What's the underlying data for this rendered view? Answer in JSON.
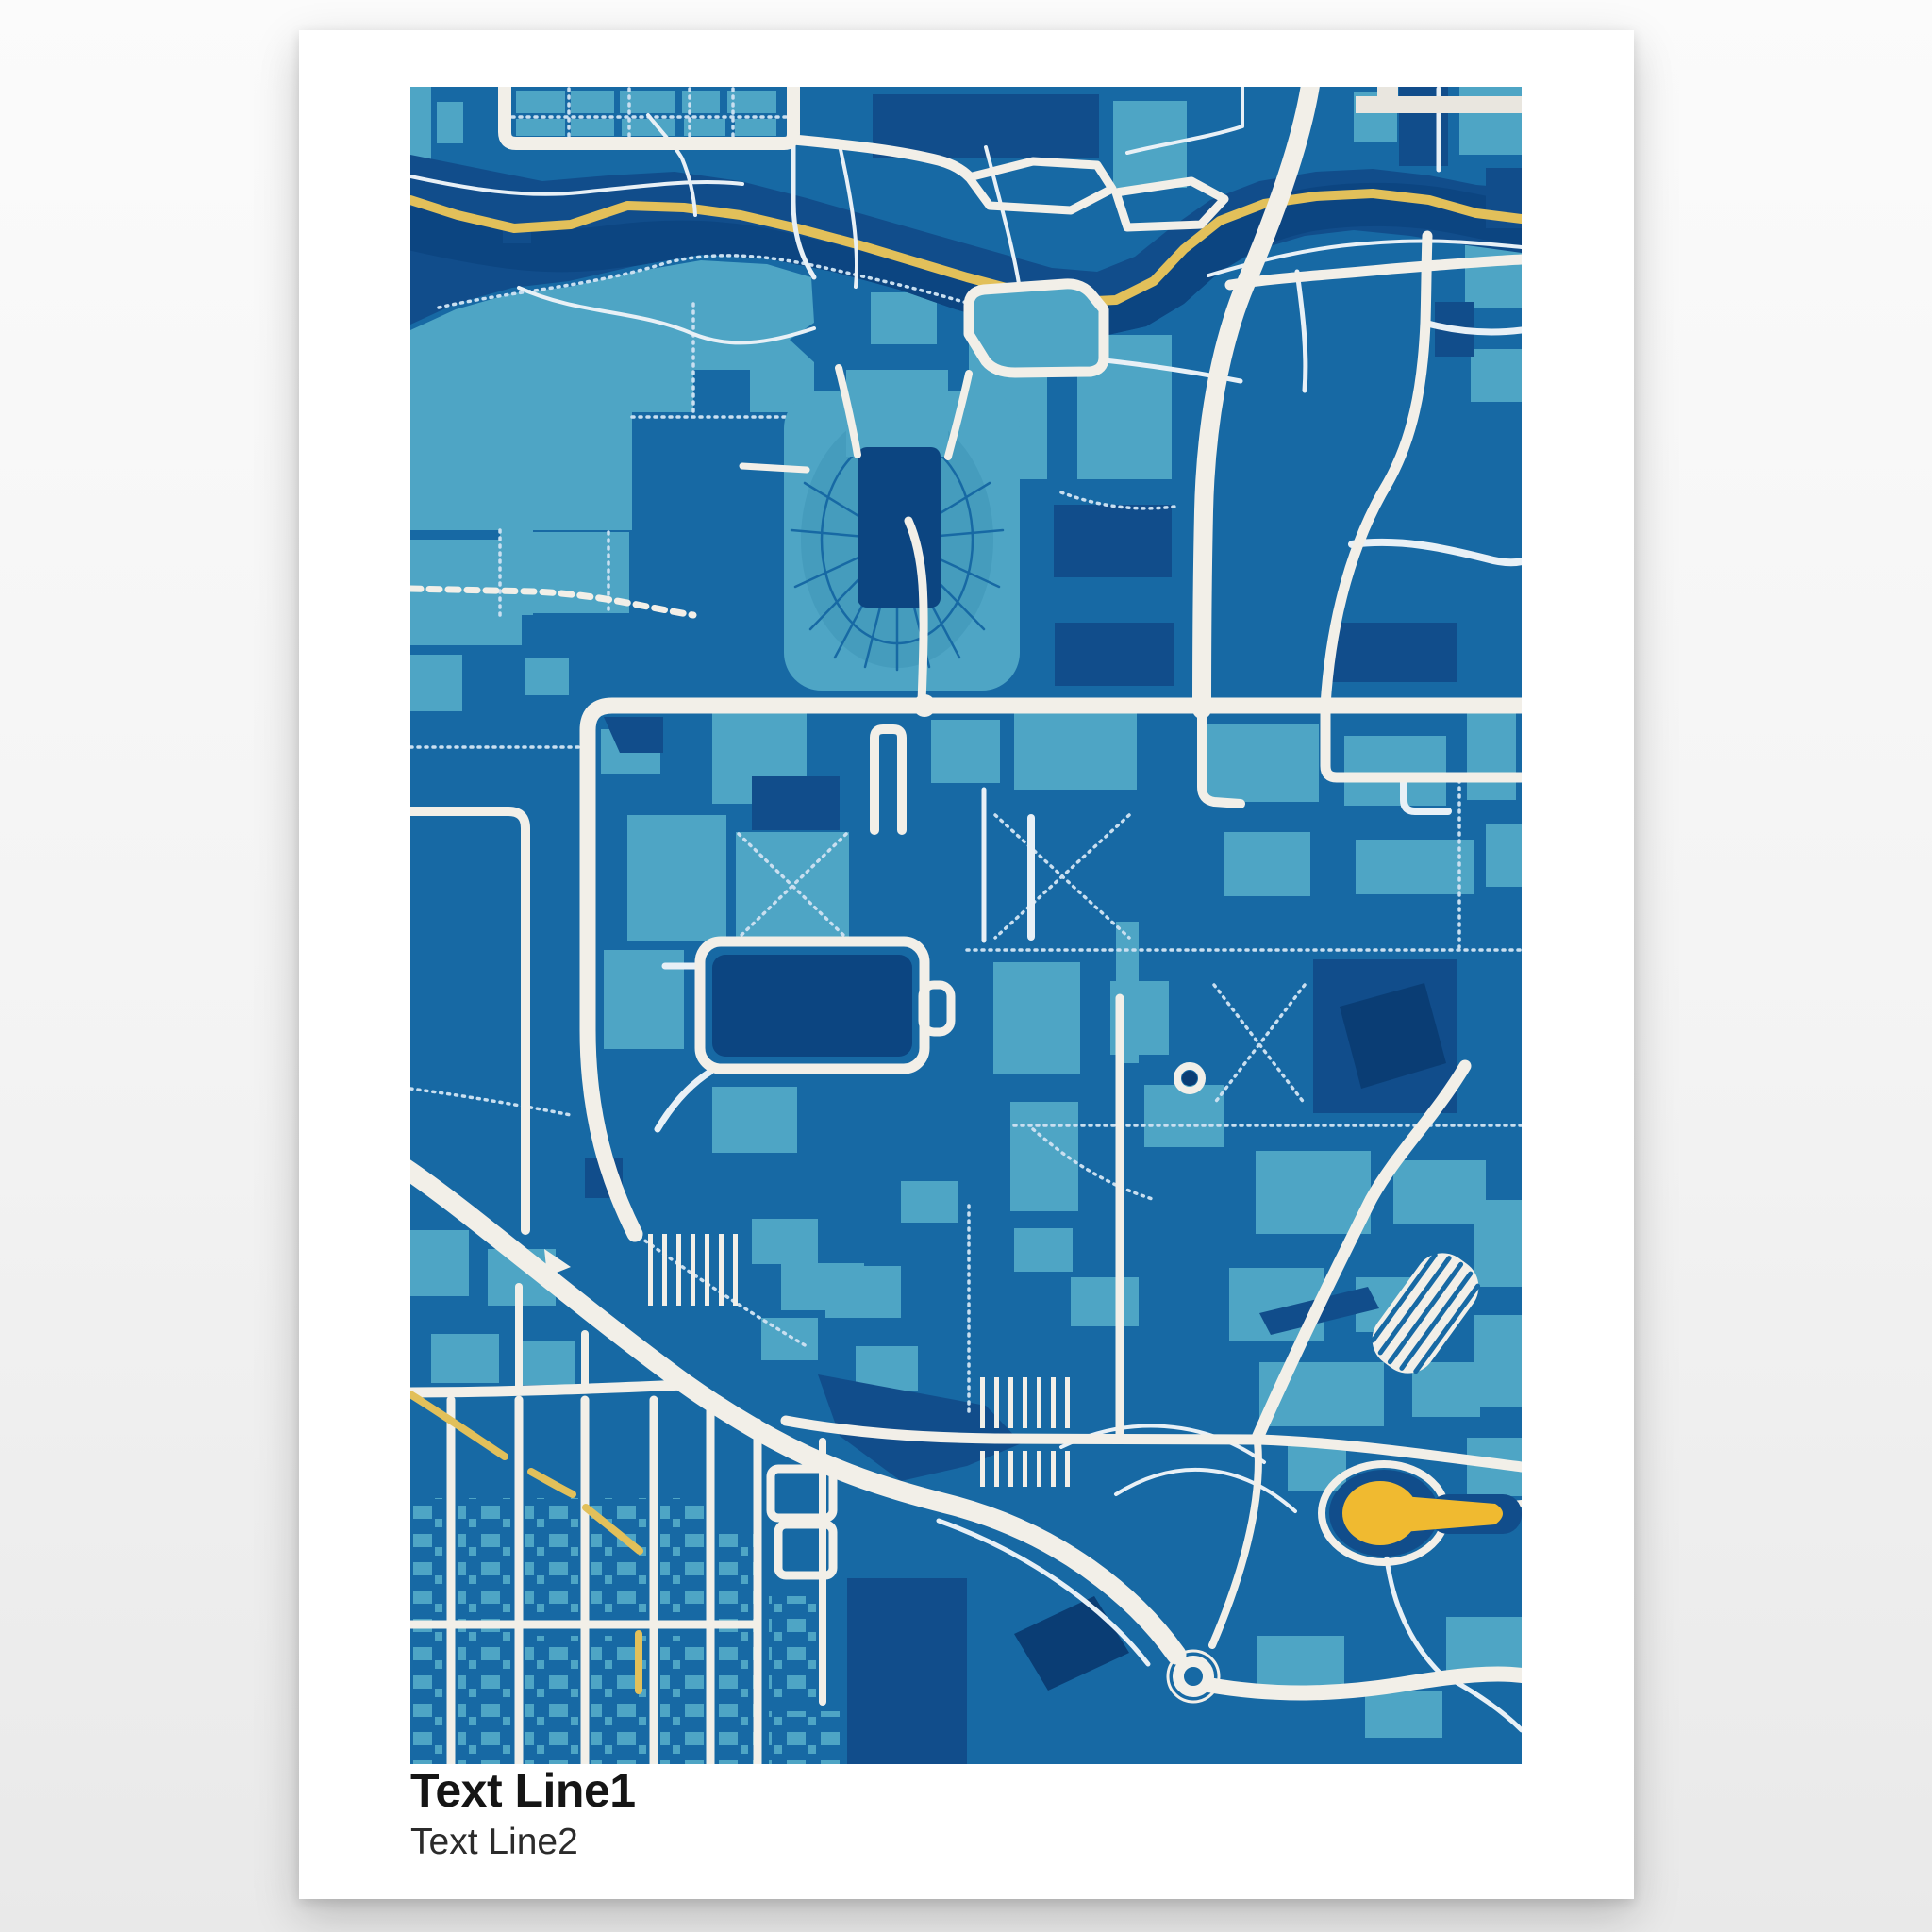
{
  "poster": {
    "text_line1": "Text Line1",
    "text_line2": "Text Line2"
  },
  "map": {
    "type": "stylized-city-street-map",
    "orientation": "portrait",
    "features": [
      "river-with-waterside-road",
      "stadium-horseshoe",
      "campus-blocks",
      "reservoir-loop",
      "diagonal-highway",
      "roundabout",
      "yellow-pond",
      "residential-grid"
    ],
    "theme": {
      "base": "#1769a4",
      "cyan": "#4ea5c5",
      "cyan2": "#459cbd",
      "navy": "#114d8b",
      "navyd": "#0c4581",
      "deep": "#0a3d74",
      "road": "#f2efe8",
      "thin": "#e8f0f6",
      "dot": "#c9dff0",
      "yellow": "#e2c05a",
      "pond": "#f0ba30",
      "band": "#e9e6df",
      "paper": "#ffffff",
      "page": "#f1f1f1",
      "ink": "#151515"
    }
  }
}
